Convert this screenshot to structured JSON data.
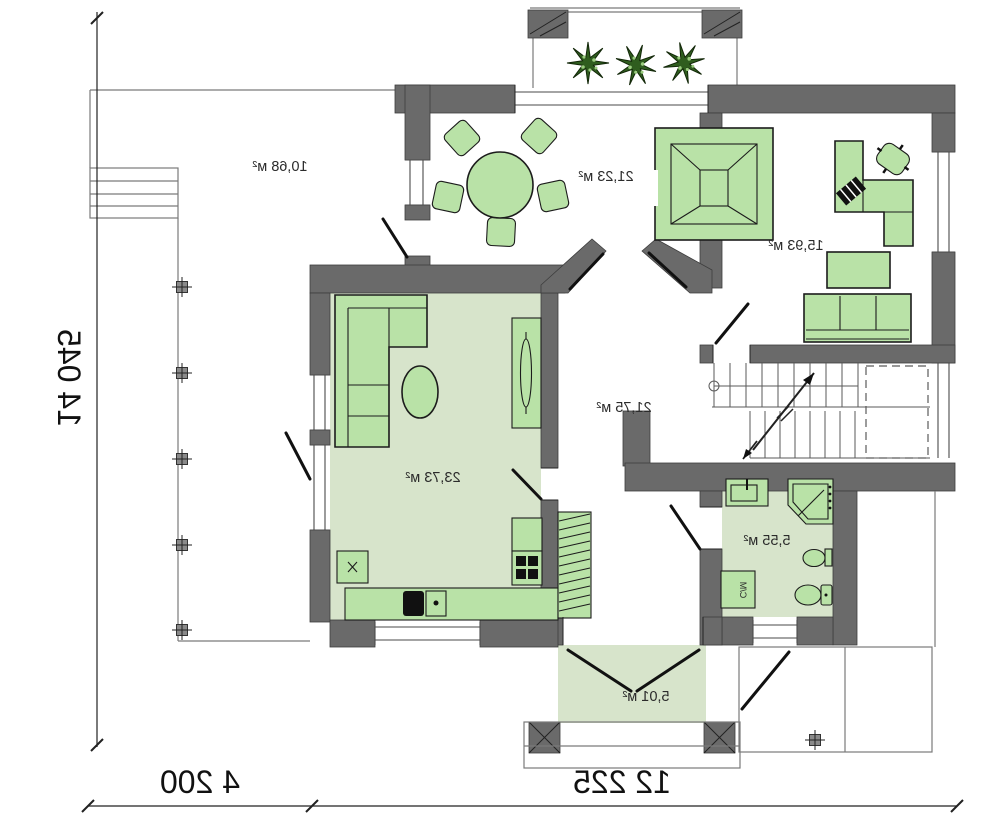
{
  "plan": {
    "rooms": [
      {
        "id": "terrace",
        "area_label": "10,68 м²"
      },
      {
        "id": "dining-room",
        "area_label": "21,23 м²"
      },
      {
        "id": "study",
        "area_label": "15,93 м²"
      },
      {
        "id": "living-room-kitchen",
        "area_label": "23,73 м²"
      },
      {
        "id": "hall",
        "area_label": "21,75 м²"
      },
      {
        "id": "bathroom",
        "area_label": "5,55 м²"
      },
      {
        "id": "entrance-porch",
        "area_label": "5,01 м²"
      }
    ],
    "dimensions": {
      "left_total": "14 045",
      "bottom_left": "4 200",
      "bottom_right": "12 225"
    },
    "appliance_labels": {
      "washing_machine": "С/М"
    },
    "colors": {
      "wall": "#6a6a6a",
      "furniture_fill": "#b9e2a7",
      "floor_fill": "#d7e4cb",
      "plant": "#2f5d1e",
      "line": "#1c1c1c"
    },
    "icons": [
      "dining-table-icon",
      "chair-icon",
      "fireplace-icon",
      "desk-icon",
      "office-chair-icon",
      "sofa-icon",
      "corner-sofa-icon",
      "coffee-table-icon",
      "tv-cabinet-icon",
      "kitchen-counter-icon",
      "sink-icon",
      "stove-icon",
      "wardrobe-icon",
      "shower-icon",
      "washbasin-icon",
      "bidet-icon",
      "toilet-icon",
      "washing-machine-icon",
      "plant-icon",
      "stairs-icon",
      "column-icon",
      "door-icon",
      "window-icon"
    ]
  }
}
